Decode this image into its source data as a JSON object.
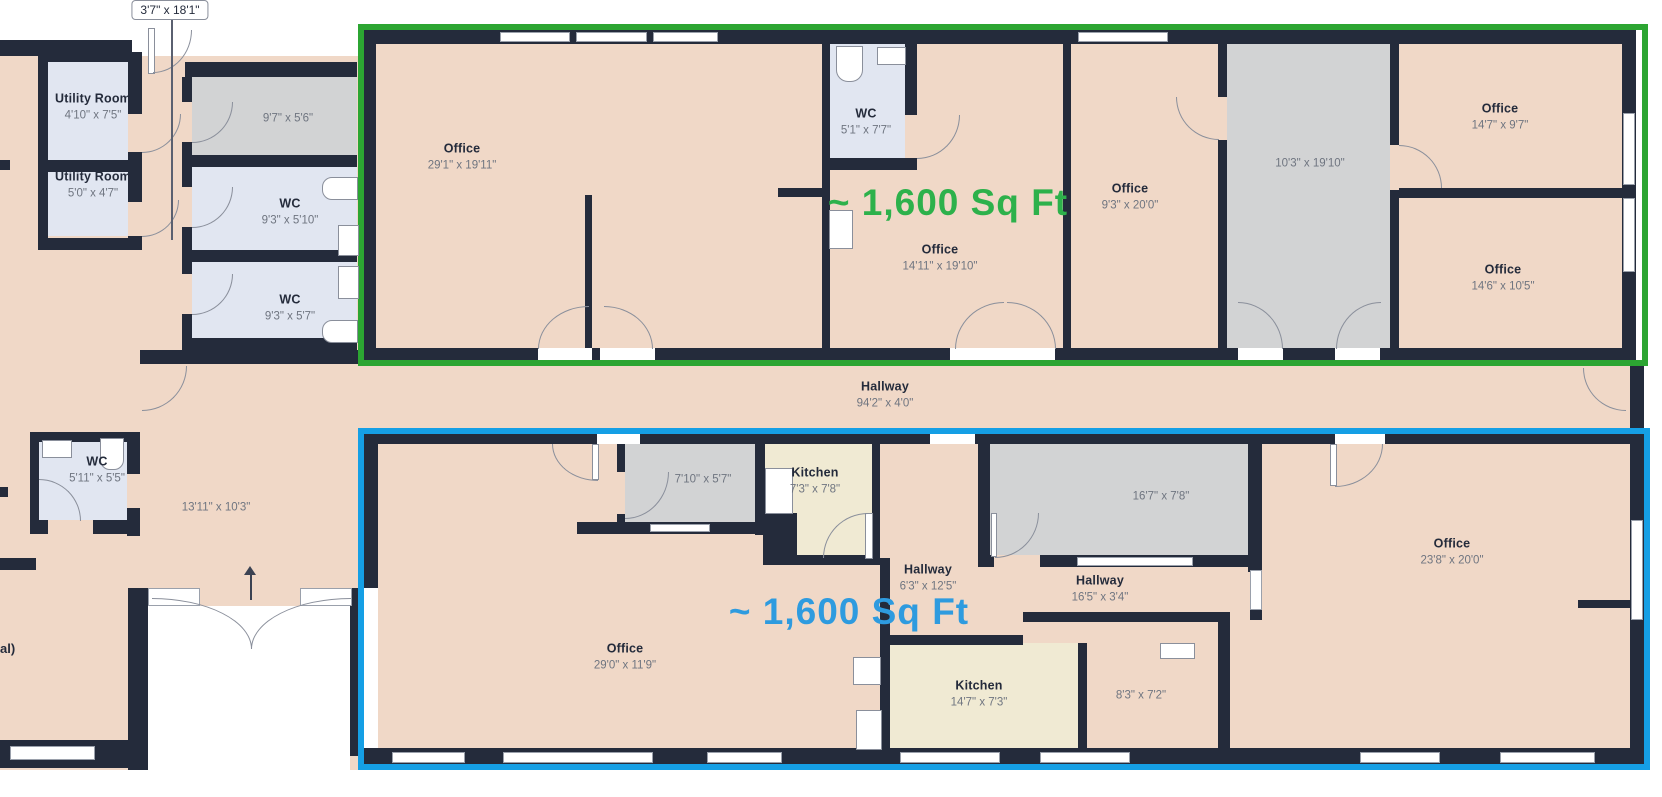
{
  "palette": {
    "wall": "#242B3B",
    "floor": "#F0D8C7",
    "room_gray": "#D2D3D4",
    "room_blue": "#E1E6F1",
    "room_beige": "#F0EAD3"
  },
  "highlights": {
    "green": {
      "label": "~ 1,600 Sq Ft",
      "color": "#2DB14B",
      "border": "#2CA532"
    },
    "blue": {
      "label": "~ 1,600 Sq Ft",
      "color": "#2E9BDF",
      "border": "#159FE5"
    }
  },
  "callout": {
    "dims": "3'7\" x 18'1\""
  },
  "edge_label": "al)",
  "rooms": {
    "utility1": {
      "name": "Utility Room",
      "dims": "4'10\" x 7'5\""
    },
    "utility2": {
      "name": "Utility Room",
      "dims": "5'0\" x 4'7\""
    },
    "store9_7": {
      "dims": "9'7\" x 5'6\""
    },
    "wc9_3a": {
      "name": "WC",
      "dims": "9'3\" x 5'10\""
    },
    "wc9_3b": {
      "name": "WC",
      "dims": "9'3\" x 5'7\""
    },
    "office29_1": {
      "name": "Office",
      "dims": "29'1\" x 19'11\""
    },
    "wc5_1": {
      "name": "WC",
      "dims": "5'1\" x 7'7\""
    },
    "office14_11": {
      "name": "Office",
      "dims": "14'11\" x 19'10\""
    },
    "office9_3": {
      "name": "Office",
      "dims": "9'3\" x 20'0\""
    },
    "store10_3": {
      "dims": "10'3\" x 19'10\""
    },
    "office14_7": {
      "name": "Office",
      "dims": "14'7\" x 9'7\""
    },
    "office14_6": {
      "name": "Office",
      "dims": "14'6\" x 10'5\""
    },
    "hallway94": {
      "name": "Hallway",
      "dims": "94'2\" x 4'0\""
    },
    "wc5_11": {
      "name": "WC",
      "dims": "5'11\" x 5'5\""
    },
    "room13_11": {
      "dims": "13'11\" x 10'3\""
    },
    "store7_10": {
      "dims": "7'10\" x 5'7\""
    },
    "kitchen7_3": {
      "name": "Kitchen",
      "dims": "7'3\" x 7'8\""
    },
    "hallway6_3": {
      "name": "Hallway",
      "dims": "6'3\" x 12'5\""
    },
    "store16_7": {
      "dims": "16'7\" x 7'8\""
    },
    "hallway16_5": {
      "name": "Hallway",
      "dims": "16'5\" x 3'4\""
    },
    "office29_0": {
      "name": "Office",
      "dims": "29'0\" x 11'9\""
    },
    "kitchen14_7": {
      "name": "Kitchen",
      "dims": "14'7\" x 7'3\""
    },
    "room8_3": {
      "dims": "8'3\" x 7'2\""
    },
    "office23_8": {
      "name": "Office",
      "dims": "23'8\" x 20'0\""
    }
  }
}
